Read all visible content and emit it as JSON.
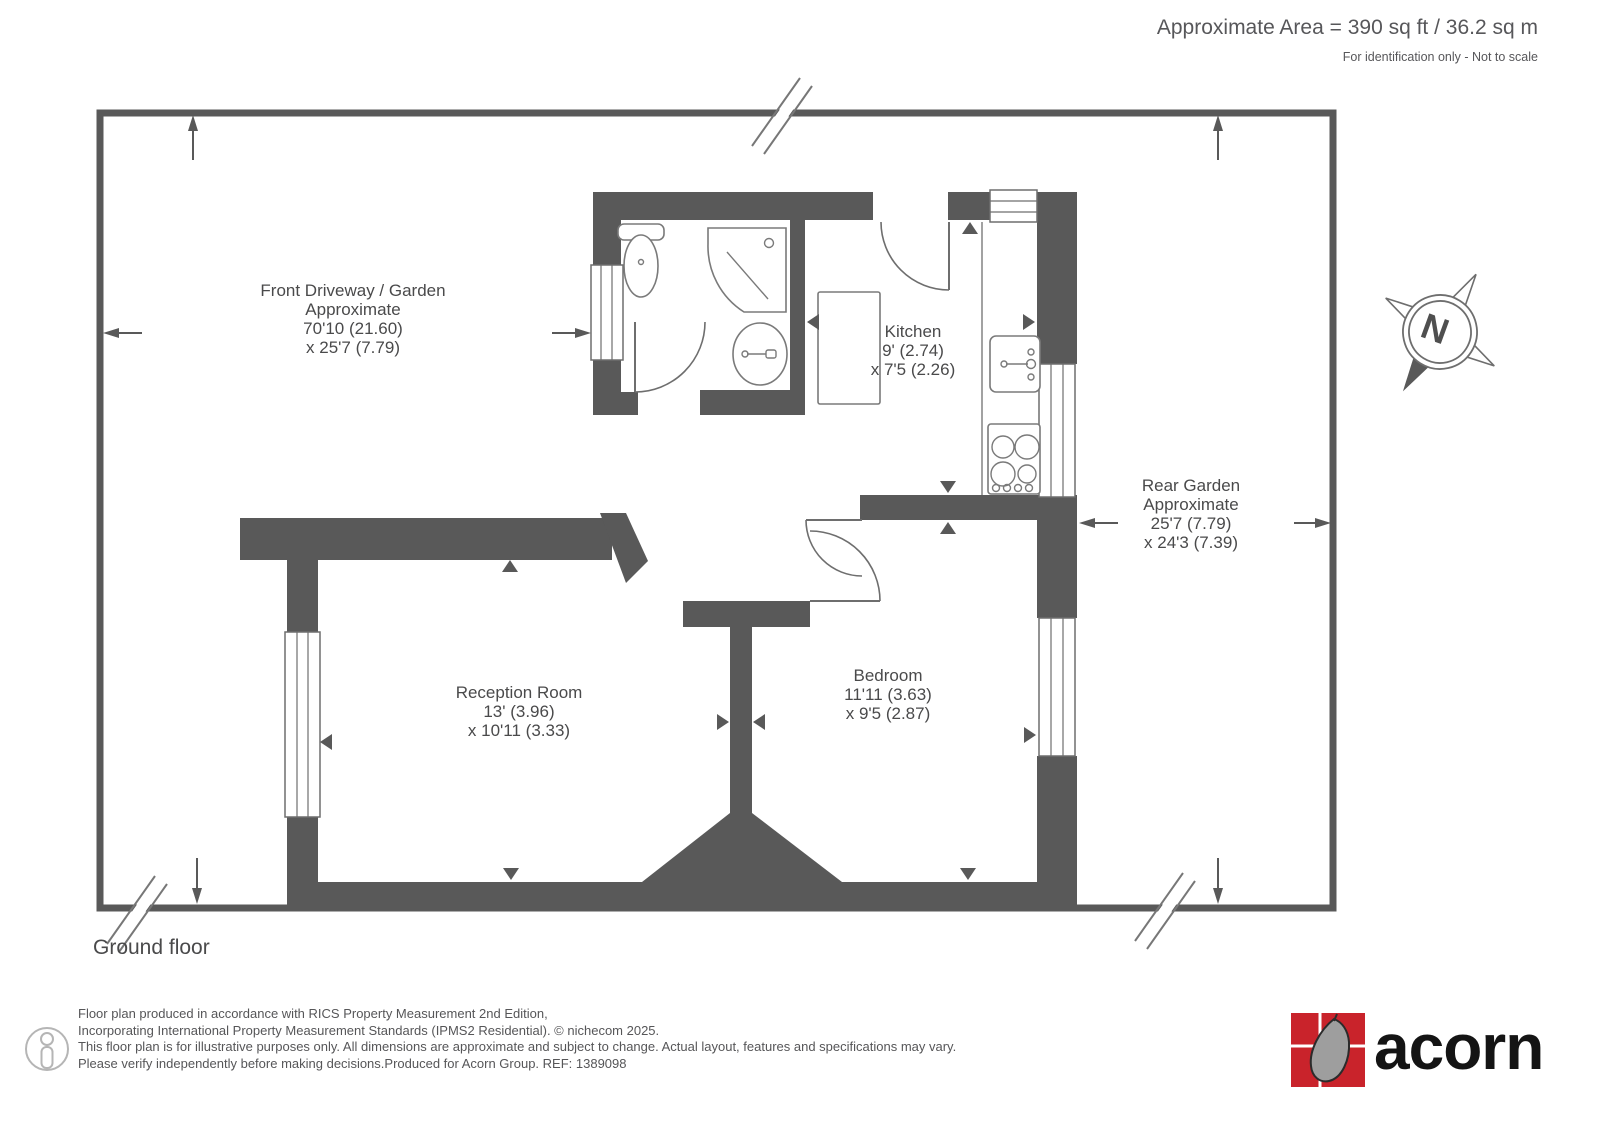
{
  "header": {
    "area": "Approximate Area = 390 sq ft / 36.2 sq m",
    "note": "For identification only - Not to scale"
  },
  "plan": {
    "floor_label": "Ground floor",
    "compass_n": "N",
    "rooms": {
      "front_garden": {
        "lines": [
          "Front Driveway / Garden",
          "Approximate",
          "70'10 (21.60)",
          "x 25'7 (7.79)"
        ]
      },
      "kitchen": {
        "lines": [
          "Kitchen",
          "9' (2.74)",
          "x 7'5 (2.26)"
        ]
      },
      "rear_garden": {
        "lines": [
          "Rear Garden",
          "Approximate",
          "25'7 (7.79)",
          "x 24'3 (7.39)"
        ]
      },
      "reception": {
        "lines": [
          "Reception Room",
          "13' (3.96)",
          "x 10'11 (3.33)"
        ]
      },
      "bedroom": {
        "lines": [
          "Bedroom",
          "11'11 (3.63)",
          "x 9'5 (2.87)"
        ]
      }
    }
  },
  "footer": {
    "disclaimer": [
      "Floor plan produced in accordance with RICS Property Measurement 2nd Edition,",
      "Incorporating International Property Measurement Standards (IPMS2 Residential).   © nichecom 2025.",
      "This floor plan is for illustrative purposes only. All dimensions are approximate and subject to change. Actual layout, features and specifications may vary.",
      "Please verify independently before making decisions.Produced for Acorn Group.   REF: 1389098"
    ],
    "brand": "acorn"
  },
  "colors": {
    "wall": "#595959",
    "brand_red": "#c9232b",
    "text": "#4a4a4b"
  }
}
